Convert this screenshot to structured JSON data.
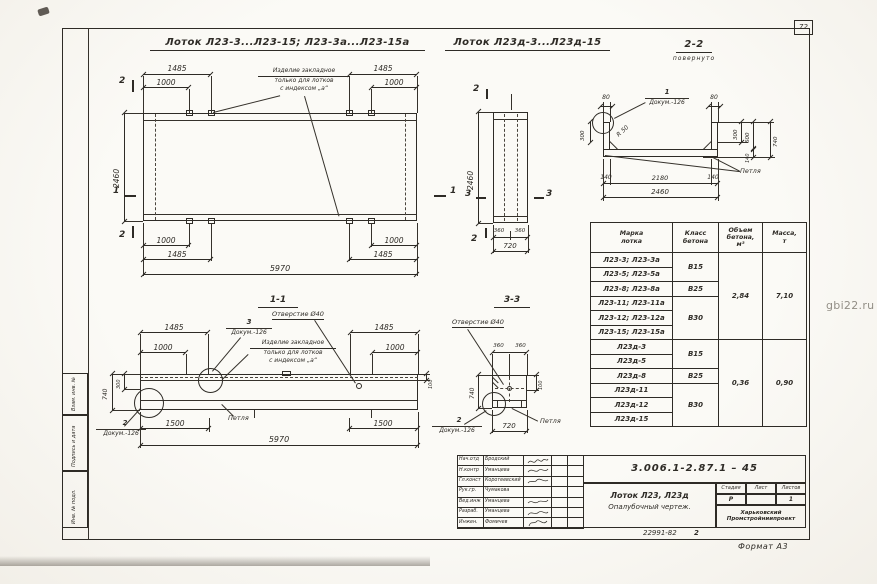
{
  "frame": {
    "page_number": "72",
    "format_label": "Формат А3",
    "doc_code": "22991-82",
    "doc_code_sheet": "2",
    "watermark": "gbi22.ru",
    "margin_boxes": [
      "Взам. инв. №",
      "Подпись и дата",
      "Инв. № подл."
    ]
  },
  "titles": {
    "plan1": "Лоток Л23-3...Л23-15; Л23-3а...Л23-15а",
    "plan2": "Лоток Л23д-3...Л23д-15",
    "s22": "2-2",
    "s22_note": "повернуто",
    "s11": "1-1",
    "s33": "3-3"
  },
  "labels": {
    "hole": "Отверстие Ø40",
    "loop": "Петля",
    "radius": "R 50",
    "doc": "Докум.-126",
    "c1": "1",
    "c2": "2",
    "c3": "3",
    "note_l1": "Изделие закладное",
    "note_l2": "только для лотков",
    "note_l3": "с индексом „а“"
  },
  "marks": {
    "m1": "1",
    "m2": "2",
    "m3": "3"
  },
  "dims": {
    "p1_1485": "1485",
    "p1_1000": "1000",
    "p1_2460": "2460",
    "p1_5970": "5970",
    "p2_2460": "2460",
    "p2_360": "360",
    "p2_720": "720",
    "s22_80": "80",
    "s22_300l": "300",
    "s22_300r": "300",
    "s22_600": "600",
    "s22_140r": "140",
    "s22_740": "740",
    "s22_140b": "140",
    "s22_2180": "2180",
    "s22_2460": "2460",
    "s11_1485": "1485",
    "s11_1000": "1000",
    "s11_740": "740",
    "s11_300": "300",
    "s11_100": "100",
    "s11_1500": "1500",
    "s11_5970": "5970",
    "s33_360": "360",
    "s33_740": "740",
    "s33_100": "100",
    "s33_720": "720"
  },
  "table": {
    "headers": [
      "Марка\nлотка",
      "Класс\nбетона",
      "Объем\nбетона,\nм³",
      "Масса,\nт"
    ],
    "marks": [
      "Л23-3; Л23-3а",
      "Л23-5; Л23-5а",
      "Л23-8; Л23-8а",
      "Л23-11; Л23-11а",
      "Л23-12; Л23-12а",
      "Л23-15; Л23-15а",
      "Л23д-3",
      "Л23д-5",
      "Л23д-8",
      "Л23д-11",
      "Л23д-12",
      "Л23д-15"
    ],
    "classes": [
      "В15",
      "В25",
      "В30",
      "В15",
      "В25",
      "В30"
    ],
    "volumes": [
      "2,84",
      "0,36"
    ],
    "masses": [
      "7,10",
      "0,90"
    ]
  },
  "stamp": {
    "doc_number": "3.006.1-2.87.1 – 45",
    "rows": [
      {
        "role": "Нач.отд",
        "name": "Бродский"
      },
      {
        "role": "Н.контр",
        "name": "Уманцева"
      },
      {
        "role": "Гл.конст",
        "name": "Коротеевский"
      },
      {
        "role": "Рук.гр.",
        "name": "Чумакова"
      },
      {
        "role": "Вед.инж",
        "name": "Уманцева"
      },
      {
        "role": "Разраб.",
        "name": "Уманцева"
      },
      {
        "role": "Инжен.",
        "name": "Фомичев"
      }
    ],
    "title_line1": "Лоток Л23, Л23д",
    "title_line2": "Опалубочный чертеж.",
    "stage_label": "Стадия",
    "sheet_label": "Лист",
    "sheets_label": "Листов",
    "stage_value": "Р",
    "sheet_value": "",
    "sheets_value": "1",
    "org": "Харьковский\nПромстройниипроект"
  }
}
